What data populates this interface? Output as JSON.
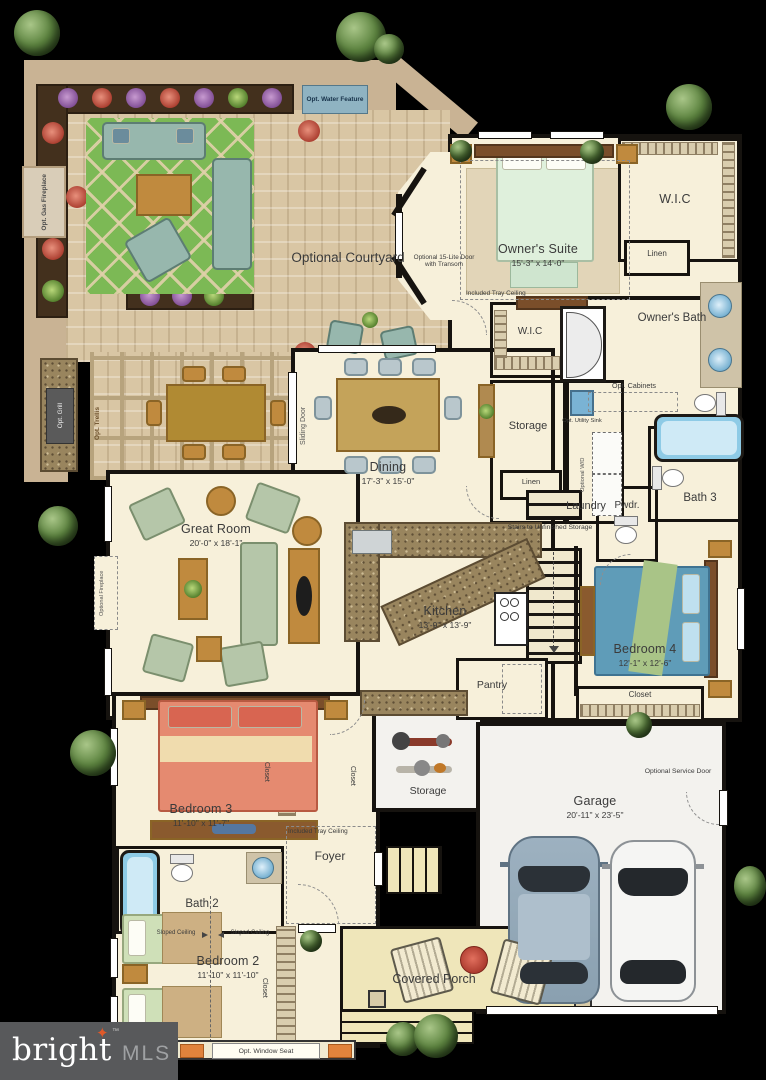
{
  "logo": {
    "brand": "bright",
    "tm": "™",
    "suffix": "MLS"
  },
  "rooms": {
    "courtyard": {
      "label": "Optional Courtyard"
    },
    "owners_suite": {
      "label": "Owner's Suite",
      "dims": "15'-3\" x 14'-0\""
    },
    "wic_top": {
      "label": "W.I.C"
    },
    "linen_top": {
      "label": "Linen"
    },
    "owners_bath": {
      "label": "Owner's Bath"
    },
    "wic_hall": {
      "label": "W.I.C"
    },
    "storage_hall": {
      "label": "Storage"
    },
    "laundry": {
      "label": "Laundry"
    },
    "linen_hall": {
      "label": "Linen"
    },
    "bath3": {
      "label": "Bath 3"
    },
    "pwdr": {
      "label": "Pwdr."
    },
    "dining": {
      "label": "Dining",
      "dims": "17'-3\" x 15'-0\""
    },
    "great_room": {
      "label": "Great Room",
      "dims": "20'-0\" x 18'-1\""
    },
    "kitchen": {
      "label": "Kitchen",
      "dims": "13'-9\" x 13'-9\""
    },
    "pantry": {
      "label": "Pantry"
    },
    "bedroom4": {
      "label": "Bedroom 4",
      "dims": "12'-1\" x 12'-6\""
    },
    "closet_bedroom4": {
      "label": "Closet"
    },
    "bedroom3": {
      "label": "Bedroom 3",
      "dims": "11'-10\" x 11'-7\""
    },
    "closet_bedroom3": {
      "label": "Closet"
    },
    "closet_foyer": {
      "label": "Closet"
    },
    "bath2": {
      "label": "Bath 2"
    },
    "foyer": {
      "label": "Foyer"
    },
    "bedroom2": {
      "label": "Bedroom 2",
      "dims": "11'-10\" x 11'-10\""
    },
    "closet_bedroom2": {
      "label": "Closet"
    },
    "storage_garage": {
      "label": "Storage"
    },
    "garage": {
      "label": "Garage",
      "dims": "20'-11\" x 23'-5\""
    },
    "covered_porch": {
      "label": "Covered Porch"
    }
  },
  "annotations": {
    "water_feature": "Opt. Water Feature",
    "gas_fireplace": "Opt. Gas Fireplace",
    "grill": "Opt. Grill",
    "trellis": "Opt. Trellis",
    "sliding_door": "Sliding Door",
    "door_transom": "Optional 15-Lite Door with Transom",
    "tray_owner": "Included Tray Ceiling",
    "tray_foyer": "Included Tray Ceiling",
    "opt_cabinets": "Opt. Cabinets",
    "utility_sink": "Opt. Utility Sink",
    "optional_wd": "Optional W/D",
    "stairs": "Stairs to Unfinished Storage",
    "optional_fireplace": "Optional Fireplace",
    "service_door": "Optional Service Door",
    "sloped_left": "Sloped Ceiling",
    "sloped_right": "Sloped Ceiling",
    "window_seat": "Opt. Window Seat"
  },
  "colors": {
    "background": "#000000",
    "floor": "#f7f0da",
    "paving": "#d9c6a4",
    "courtyard_wall": "#c9b394",
    "planting_bed": "#43301d",
    "rug_green": "#7cb955",
    "sofa_teal": "#97b7ad",
    "wood": "#c08a3e",
    "granite": "#99855e",
    "owner_bed": "#dff0dc",
    "bed4_blue": "#5f9cb8",
    "bed3_salmon": "#e58a70",
    "porch": "#efe6ba",
    "garage_floor": "#f3f2ee",
    "water_feature": "#8fb3c2",
    "tub_blue": "#8ecbe6",
    "logo_bg": "#58595b",
    "logo_star": "#e05929"
  }
}
